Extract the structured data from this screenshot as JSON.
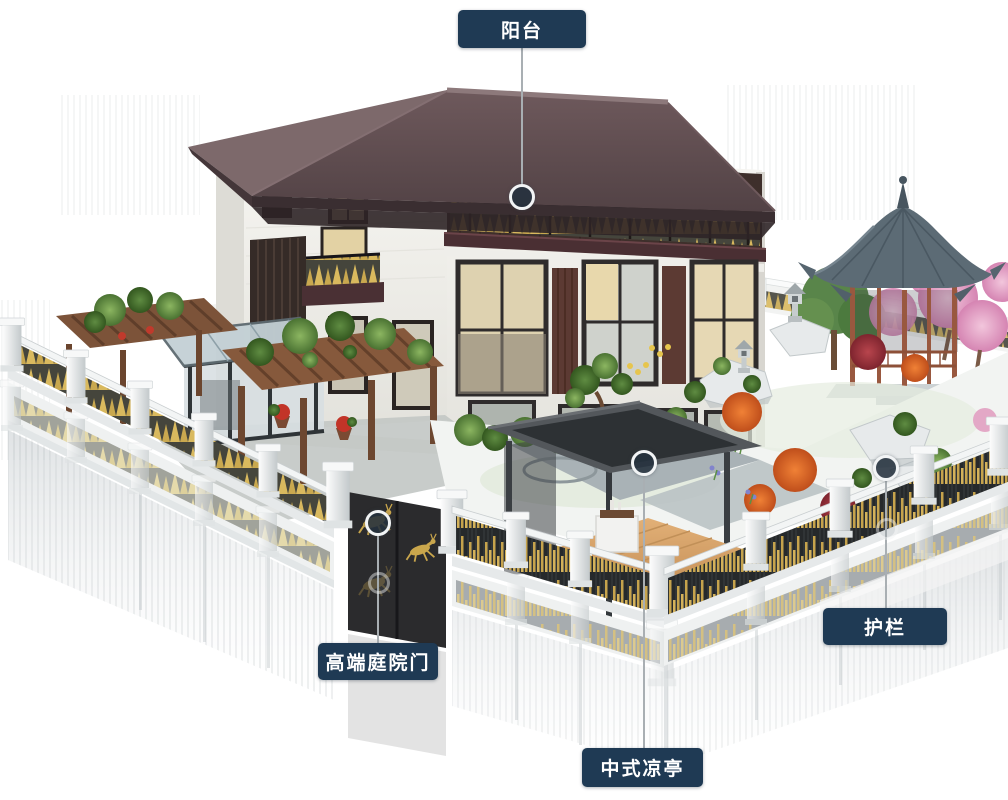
{
  "callouts": {
    "balcony": {
      "label": "阳台"
    },
    "gate": {
      "label": "高端庭院门"
    },
    "pavilion": {
      "label": "中式凉亭"
    },
    "railing": {
      "label": "护栏"
    }
  },
  "colors": {
    "label_background": "#1f3a54",
    "label_text": "#ffffff",
    "leader_line": "#a9afb3",
    "marker_ring": "#f2f4f5",
    "marker_fill": "#24313d",
    "accent_gold": "#c9a84f",
    "villa_roof": "#5d4a4d",
    "pavilion_roof": "#5c6b75",
    "scene_background": "#ffffff"
  }
}
